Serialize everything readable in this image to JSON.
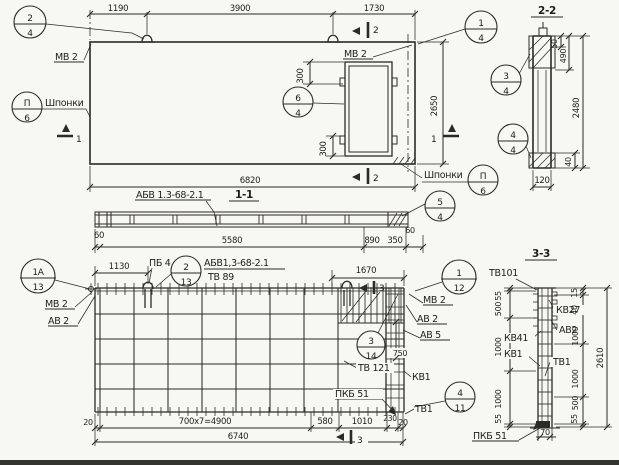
{
  "sheet": {
    "background": "#f7f7f4",
    "ink": "#2b2a26"
  },
  "plan": {
    "dims": {
      "top_left": "1190",
      "top_mid": "3900",
      "top_right": "1730",
      "bottom": "6820",
      "right": "2650",
      "opening_top": "300",
      "opening_bottom": "300"
    },
    "labels": {
      "mv2_left": "МВ 2",
      "mv2_right": "МВ 2",
      "shponki_left": "Шпонки",
      "shponki_right": "Шпонки"
    },
    "callouts": {
      "c24": {
        "num": "2",
        "den": "4"
      },
      "c14": {
        "num": "1",
        "den": "4"
      },
      "c64": {
        "num": "6",
        "den": "4"
      },
      "key_left": {
        "num": "П",
        "den": "6"
      },
      "key_right": {
        "num": "П",
        "den": "6"
      }
    },
    "cuts": {
      "c1": "1",
      "c2": "2"
    }
  },
  "section22": {
    "title": "2-2",
    "dims": {
      "d50": "50",
      "d490": "490",
      "d2480": "2480",
      "d40": "40",
      "d120": "120"
    },
    "callouts": {
      "c34": {
        "num": "3",
        "den": "4"
      },
      "c44": {
        "num": "4",
        "den": "4"
      }
    }
  },
  "section11": {
    "title": "1-1",
    "mark": "АБВ 1.3-68-2.1",
    "dims": {
      "d60l": "60",
      "d5580": "5580",
      "d890": "890",
      "d350": "350",
      "d60r": "60"
    },
    "callouts": {
      "c54": {
        "num": "5",
        "den": "4"
      }
    }
  },
  "rebar": {
    "title": "АБВ1,3-68-2.1",
    "subtitle": "ТВ 89",
    "dims": {
      "d1130": "1130",
      "d1670": "1670",
      "d750": "750",
      "d20l": "20",
      "d4900": "700х7=4900",
      "d580": "580",
      "d1010": "1010",
      "d230": "230",
      "d20r": "20",
      "d6740": "6740"
    },
    "labels": {
      "pb4": "ПБ 4",
      "mv2_left": "МВ 2",
      "av2_left": "АВ 2",
      "mv2_right": "МВ 2",
      "av2_right": "АВ 2",
      "av5": "АВ 5",
      "tv121": "ТВ 121",
      "kv1": "КВ1",
      "pkb51": "ПКБ 51",
      "tv1": "ТВ1"
    },
    "callouts": {
      "c1a13": {
        "num": "1А",
        "den": "13"
      },
      "c213": {
        "num": "2",
        "den": "13"
      },
      "c314": {
        "num": "3",
        "den": "14"
      },
      "c411": {
        "num": "4",
        "den": "11"
      },
      "c112": {
        "num": "1",
        "den": "12"
      }
    },
    "cuts": {
      "c3": "3"
    }
  },
  "section33": {
    "title": "3-3",
    "dims": {
      "left": [
        "55",
        "500",
        "1000",
        "1000",
        "55"
      ],
      "right": [
        "15",
        "40",
        "1000",
        "1000",
        "500",
        "55"
      ],
      "total": "2610",
      "d70": "70"
    },
    "labels": {
      "tv101": "ТВ101",
      "kv27": "КВ27",
      "av2": "АВ2",
      "kv41": "КВ41",
      "kv1": "КВ1",
      "tv1": "ТВ1",
      "pkb51": "ПКБ 51"
    }
  }
}
